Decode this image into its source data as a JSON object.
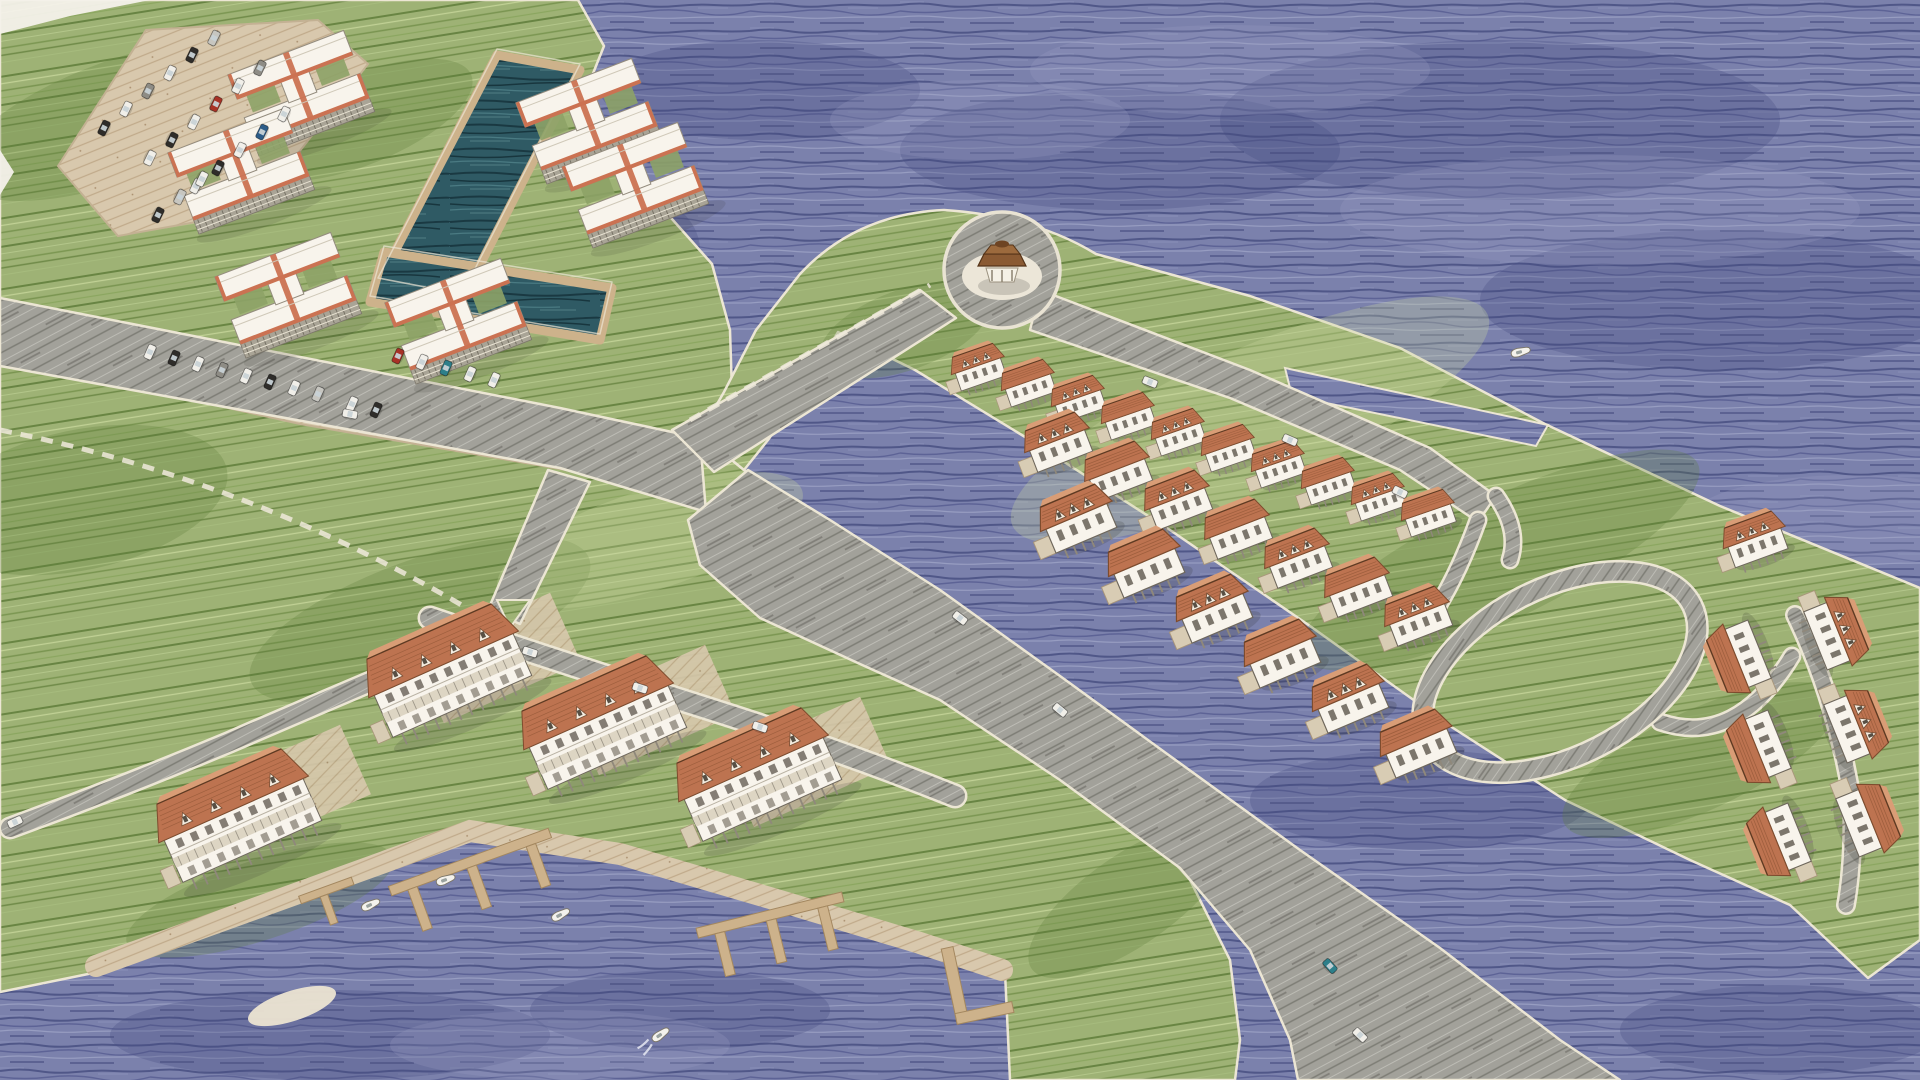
{
  "scene": {
    "palette": {
      "water_base": "#7b81ac",
      "water_dark": "#454c80",
      "water_mid": "#5a6094",
      "water_light": "#9aa0c4",
      "grass_base": "#9eb275",
      "grass_dark": "#5f7c3a",
      "grass_mid": "#74914b",
      "grass_light": "#c9d89e",
      "road_base": "#a2a19a",
      "road_dark": "#6e6d65",
      "road_light": "#cfcec7",
      "curb": "#ece6d4",
      "sand": "#d8c8ad",
      "sand_dark": "#b79c7b",
      "dock": "#cdb28b",
      "dock_dark": "#a3875f",
      "basin": "#2f5a64",
      "basin_dark": "#16343c",
      "basin_light": "#4d7d85",
      "wall": "#f8f4ec",
      "wall_shadow": "#ddd5c3",
      "facade": "#a9a496",
      "window": "#5d564c",
      "roof": "#bd7350",
      "roof_dark": "#7e4c2e",
      "roof_light": "#d99d76",
      "trim_red": "#cb7252",
      "gazebo_roof": "#8a5a33",
      "gazebo_roof_top": "#9c6a3d",
      "boat": "#f4f2ec",
      "car_w": "#f1efe9",
      "car_k": "#2f2d2a",
      "car_g": "#8e8c85",
      "car_s": "#c7c6c0",
      "car_r": "#a83226",
      "car_b": "#2c5c88",
      "car_t": "#2d7f8a"
    },
    "water_patches_dark": [
      [
        1500,
        120,
        280,
        80
      ],
      [
        1720,
        300,
        240,
        70
      ],
      [
        1120,
        150,
        220,
        60
      ],
      [
        760,
        90,
        160,
        50
      ],
      [
        330,
        1035,
        220,
        45
      ],
      [
        1780,
        1030,
        160,
        45
      ],
      [
        1420,
        800,
        170,
        50
      ],
      [
        620,
        250,
        80,
        60
      ],
      [
        680,
        1010,
        150,
        40
      ]
    ],
    "water_patches_light": [
      [
        1600,
        210,
        260,
        55
      ],
      [
        1230,
        70,
        200,
        45
      ],
      [
        1850,
        520,
        160,
        45
      ],
      [
        560,
        1045,
        170,
        35
      ],
      [
        980,
        120,
        150,
        40
      ]
    ],
    "land": [
      {
        "name": "landmass-northwest",
        "d": "M0,0 L578,0 L604,46 L576,116 L648,192 L712,264 L730,330 L732,392 L700,434 L744,470 L860,560 L1000,680 L1100,780 L1190,880 L1230,960 L1240,1040 L1235,1080 L1010,1080 L1005,972 L920,945 L770,900 L620,856 L470,833 L93,973 L0,992 Z"
      },
      {
        "name": "peninsula-landmass",
        "d": "M700,434 L724,392 L756,330 L800,274 Q856,214 944,210 Q1034,216 1096,254 L1250,296 L1400,348 L1545,424 L1720,506 L1920,588 L1920,940 L1868,978 L1790,905 L1690,860 L1565,800 L1450,726 L1310,626 L1170,530 L1030,440 L915,370 L838,332 L806,386 L768,440 L744,470 Z"
      }
    ],
    "water_notch": "M1285,368 L1548,425 L1536,446 L1292,396 Z",
    "grass_patches_dark": [
      [
        120,
        120,
        170,
        60,
        -20
      ],
      [
        80,
        500,
        150,
        70,
        -12
      ],
      [
        420,
        620,
        180,
        60,
        -20
      ],
      [
        260,
        900,
        140,
        40,
        -18
      ],
      [
        1500,
        560,
        220,
        60,
        -26
      ],
      [
        905,
        330,
        90,
        40,
        -20
      ],
      [
        1700,
        760,
        150,
        50,
        -25
      ],
      [
        360,
        120,
        120,
        45,
        -22
      ],
      [
        1130,
        900,
        120,
        45,
        -35
      ]
    ],
    "grass_patches_light": [
      [
        1250,
        420,
        260,
        70,
        -24
      ],
      [
        650,
        540,
        160,
        50,
        -18
      ]
    ],
    "basin_arms": [
      "497,55 580,70 462,300 378,284",
      "384,252 612,288 600,340 370,302"
    ],
    "parking_lots": [
      "58,166 146,30 318,20 368,64 252,212 118,236",
      "96,336 420,388 580,430 566,470 300,424 84,376"
    ],
    "promenade": "M96,966 L470,831 L620,854 L770,898 L920,943 L1002,970",
    "driveway_pads": [
      [
        287,
        790
      ],
      [
        497,
        658
      ],
      [
        652,
        710
      ],
      [
        807,
        762
      ]
    ],
    "roads_poly": [
      {
        "name": "road-west-main",
        "pts": "0,298 560,408 700,438 706,512 560,468 0,366"
      },
      {
        "name": "road-to-plaza",
        "pts": "672,430 920,290 956,318 714,472"
      },
      {
        "name": "road-peninsula-upper",
        "pts": "1040,290 1250,370 1430,448 1496,496 1478,522 1400,470 1230,398 1030,330"
      },
      {
        "name": "road-main-southeast",
        "pts": "688,520 700,565 760,618 860,664 940,700 1060,780 1180,868 1250,950 1290,1040 1298,1080 1620,1080 1560,1040 1440,948 1300,850 1170,756 1060,676 940,590 830,520 748,470"
      },
      {
        "name": "road-connector-south",
        "pts": "548,470 590,482 520,624 488,610"
      }
    ],
    "roads_path": [
      {
        "name": "street-townhouses",
        "d": "M430,618 Q560,662 700,706 Q840,750 955,796",
        "w": 20
      },
      {
        "name": "street-west-shore",
        "d": "M470,640 Q350,690 230,742 Q120,788 10,828",
        "w": 18
      },
      {
        "name": "street-upper-ext",
        "d": "M1496,496 Q1520,530 1510,560",
        "w": 14
      },
      {
        "name": "street-loop-connector",
        "d": "M1478,520 Q1460,570 1438,606",
        "w": 14
      },
      {
        "name": "street-cluster-connector",
        "d": "M1660,722 Q1736,748 1792,656",
        "w": 14
      },
      {
        "name": "street-cluster",
        "d": "M1795,615 Q1836,700 1852,800 Q1854,860 1846,905",
        "w": 15
      }
    ],
    "loop_road": {
      "cx": 1560,
      "cy": 672,
      "rx": 148,
      "ry": 84,
      "rot": -27,
      "w": 18
    },
    "paths_dashed": [
      "M690,420 L930,285",
      "M0,430 Q250,480 470,610"
    ],
    "traffic_island": "497,600 530,600 510,628",
    "plaza": {
      "cx": 1002,
      "cy": 270,
      "r": 58
    },
    "docks": {
      "combs": [
        [
          470,
          862,
          -20,
          170
        ],
        [
          770,
          915,
          -14,
          150
        ]
      ],
      "piers": [
        [
          300,
          900,
          -20
        ]
      ],
      "l_docks": [
        [
          955,
          985,
          -12
        ]
      ]
    },
    "condos": {
      "rot": -21,
      "items": [
        [
          300,
          90
        ],
        [
          240,
          168
        ],
        [
          588,
          118
        ],
        [
          634,
          182
        ],
        [
          287,
          292
        ],
        [
          457,
          318
        ]
      ]
    },
    "townhouses": {
      "rot": -24,
      "items": [
        [
          245,
          835
        ],
        [
          455,
          690
        ],
        [
          610,
          742
        ],
        [
          765,
          794
        ]
      ]
    },
    "house_rows": [
      {
        "rot": -19,
        "s": 0.85,
        "items": [
          [
            980,
            372
          ],
          [
            1030,
            388
          ],
          [
            1080,
            404
          ],
          [
            1130,
            421
          ],
          [
            1180,
            437
          ],
          [
            1230,
            453
          ],
          [
            1280,
            469
          ],
          [
            1330,
            486
          ],
          [
            1380,
            502
          ],
          [
            1430,
            518
          ]
        ]
      },
      {
        "rot": -21,
        "s": 1.05,
        "items": [
          [
            1060,
            448
          ],
          [
            1120,
            477
          ],
          [
            1180,
            506
          ],
          [
            1240,
            535
          ],
          [
            1300,
            564
          ],
          [
            1360,
            593
          ],
          [
            1420,
            622
          ]
        ]
      },
      {
        "rot": -23,
        "s": 1.18,
        "items": [
          [
            1080,
            525
          ],
          [
            1148,
            570
          ],
          [
            1216,
            615
          ],
          [
            1284,
            660
          ],
          [
            1352,
            705
          ],
          [
            1420,
            750
          ]
        ]
      }
    ],
    "house_cluster": [
      [
        1757,
        545,
        -20,
        1,
        1
      ],
      [
        1745,
        655,
        -112,
        1.12,
        0
      ],
      [
        1830,
        635,
        68,
        1.12,
        1
      ],
      [
        1765,
        745,
        -112,
        1.12,
        0
      ],
      [
        1850,
        728,
        68,
        1.12,
        1
      ],
      [
        1785,
        838,
        -112,
        1.12,
        0
      ],
      [
        1862,
        822,
        68,
        1.12,
        0
      ]
    ],
    "cars": [
      [
        104,
        128,
        -64,
        "k"
      ],
      [
        126,
        109,
        -64,
        "w"
      ],
      [
        148,
        91,
        -64,
        "g"
      ],
      [
        170,
        73,
        -64,
        "w"
      ],
      [
        192,
        55,
        -64,
        "k"
      ],
      [
        214,
        38,
        -64,
        "s"
      ],
      [
        150,
        158,
        116,
        "w"
      ],
      [
        172,
        140,
        116,
        "k"
      ],
      [
        194,
        122,
        116,
        "w"
      ],
      [
        216,
        104,
        116,
        "r"
      ],
      [
        238,
        86,
        116,
        "w"
      ],
      [
        260,
        68,
        116,
        "g"
      ],
      [
        196,
        186,
        -64,
        "w"
      ],
      [
        218,
        168,
        -64,
        "k"
      ],
      [
        240,
        150,
        -64,
        "w"
      ],
      [
        262,
        132,
        -64,
        "b"
      ],
      [
        284,
        114,
        -64,
        "w"
      ],
      [
        158,
        215,
        116,
        "k"
      ],
      [
        180,
        197,
        116,
        "s"
      ],
      [
        202,
        179,
        116,
        "w"
      ],
      [
        150,
        352,
        -66,
        "w"
      ],
      [
        174,
        358,
        -66,
        "k"
      ],
      [
        198,
        364,
        -66,
        "w"
      ],
      [
        222,
        370,
        -66,
        "g"
      ],
      [
        246,
        376,
        -66,
        "w"
      ],
      [
        270,
        382,
        -66,
        "k"
      ],
      [
        294,
        388,
        -66,
        "w"
      ],
      [
        318,
        394,
        -66,
        "s"
      ],
      [
        398,
        356,
        -66,
        "r"
      ],
      [
        422,
        362,
        -66,
        "w"
      ],
      [
        446,
        368,
        -66,
        "t"
      ],
      [
        470,
        374,
        -66,
        "w"
      ],
      [
        494,
        380,
        -66,
        "w"
      ],
      [
        352,
        404,
        -66,
        "w"
      ],
      [
        376,
        410,
        -66,
        "k"
      ],
      [
        350,
        414,
        11,
        "w"
      ],
      [
        530,
        652,
        18,
        "w"
      ],
      [
        640,
        688,
        18,
        "w"
      ],
      [
        760,
        727,
        19,
        "w"
      ],
      [
        15,
        822,
        -25,
        "w"
      ],
      [
        1150,
        382,
        22,
        "w"
      ],
      [
        1290,
        440,
        23,
        "w"
      ],
      [
        1400,
        492,
        26,
        "w"
      ],
      [
        960,
        618,
        38,
        "w"
      ],
      [
        1060,
        710,
        40,
        "w"
      ],
      [
        1330,
        966,
        48,
        "t"
      ],
      [
        1360,
        1035,
        44,
        "w"
      ]
    ],
    "boats": [
      [
        370,
        905,
        -25,
        0
      ],
      [
        445,
        880,
        -20,
        0
      ],
      [
        560,
        915,
        -28,
        0
      ],
      [
        660,
        1035,
        -35,
        1
      ],
      [
        1520,
        352,
        -15,
        0
      ]
    ],
    "sandbar": [
      292,
      1006,
      46,
      15,
      -18
    ],
    "paper_corners": [
      "0,0 150,0 70,16 0,34",
      "0,150 0,195 14,172"
    ]
  }
}
